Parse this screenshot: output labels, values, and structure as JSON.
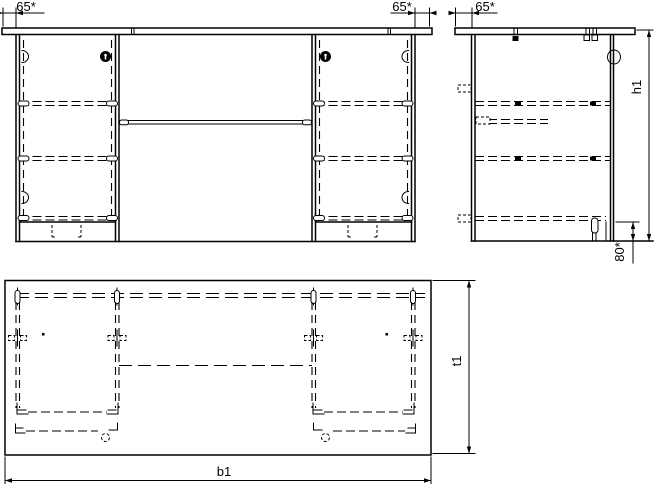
{
  "drawing": {
    "background": "#ffffff",
    "line_color": "#000000",
    "labels": {
      "front_overhang_left": "65*",
      "front_overhang_right": "65*",
      "side_overhang": "65*",
      "height": "h1",
      "plinth_height": "80*",
      "width": "b1",
      "depth": "t1"
    }
  }
}
